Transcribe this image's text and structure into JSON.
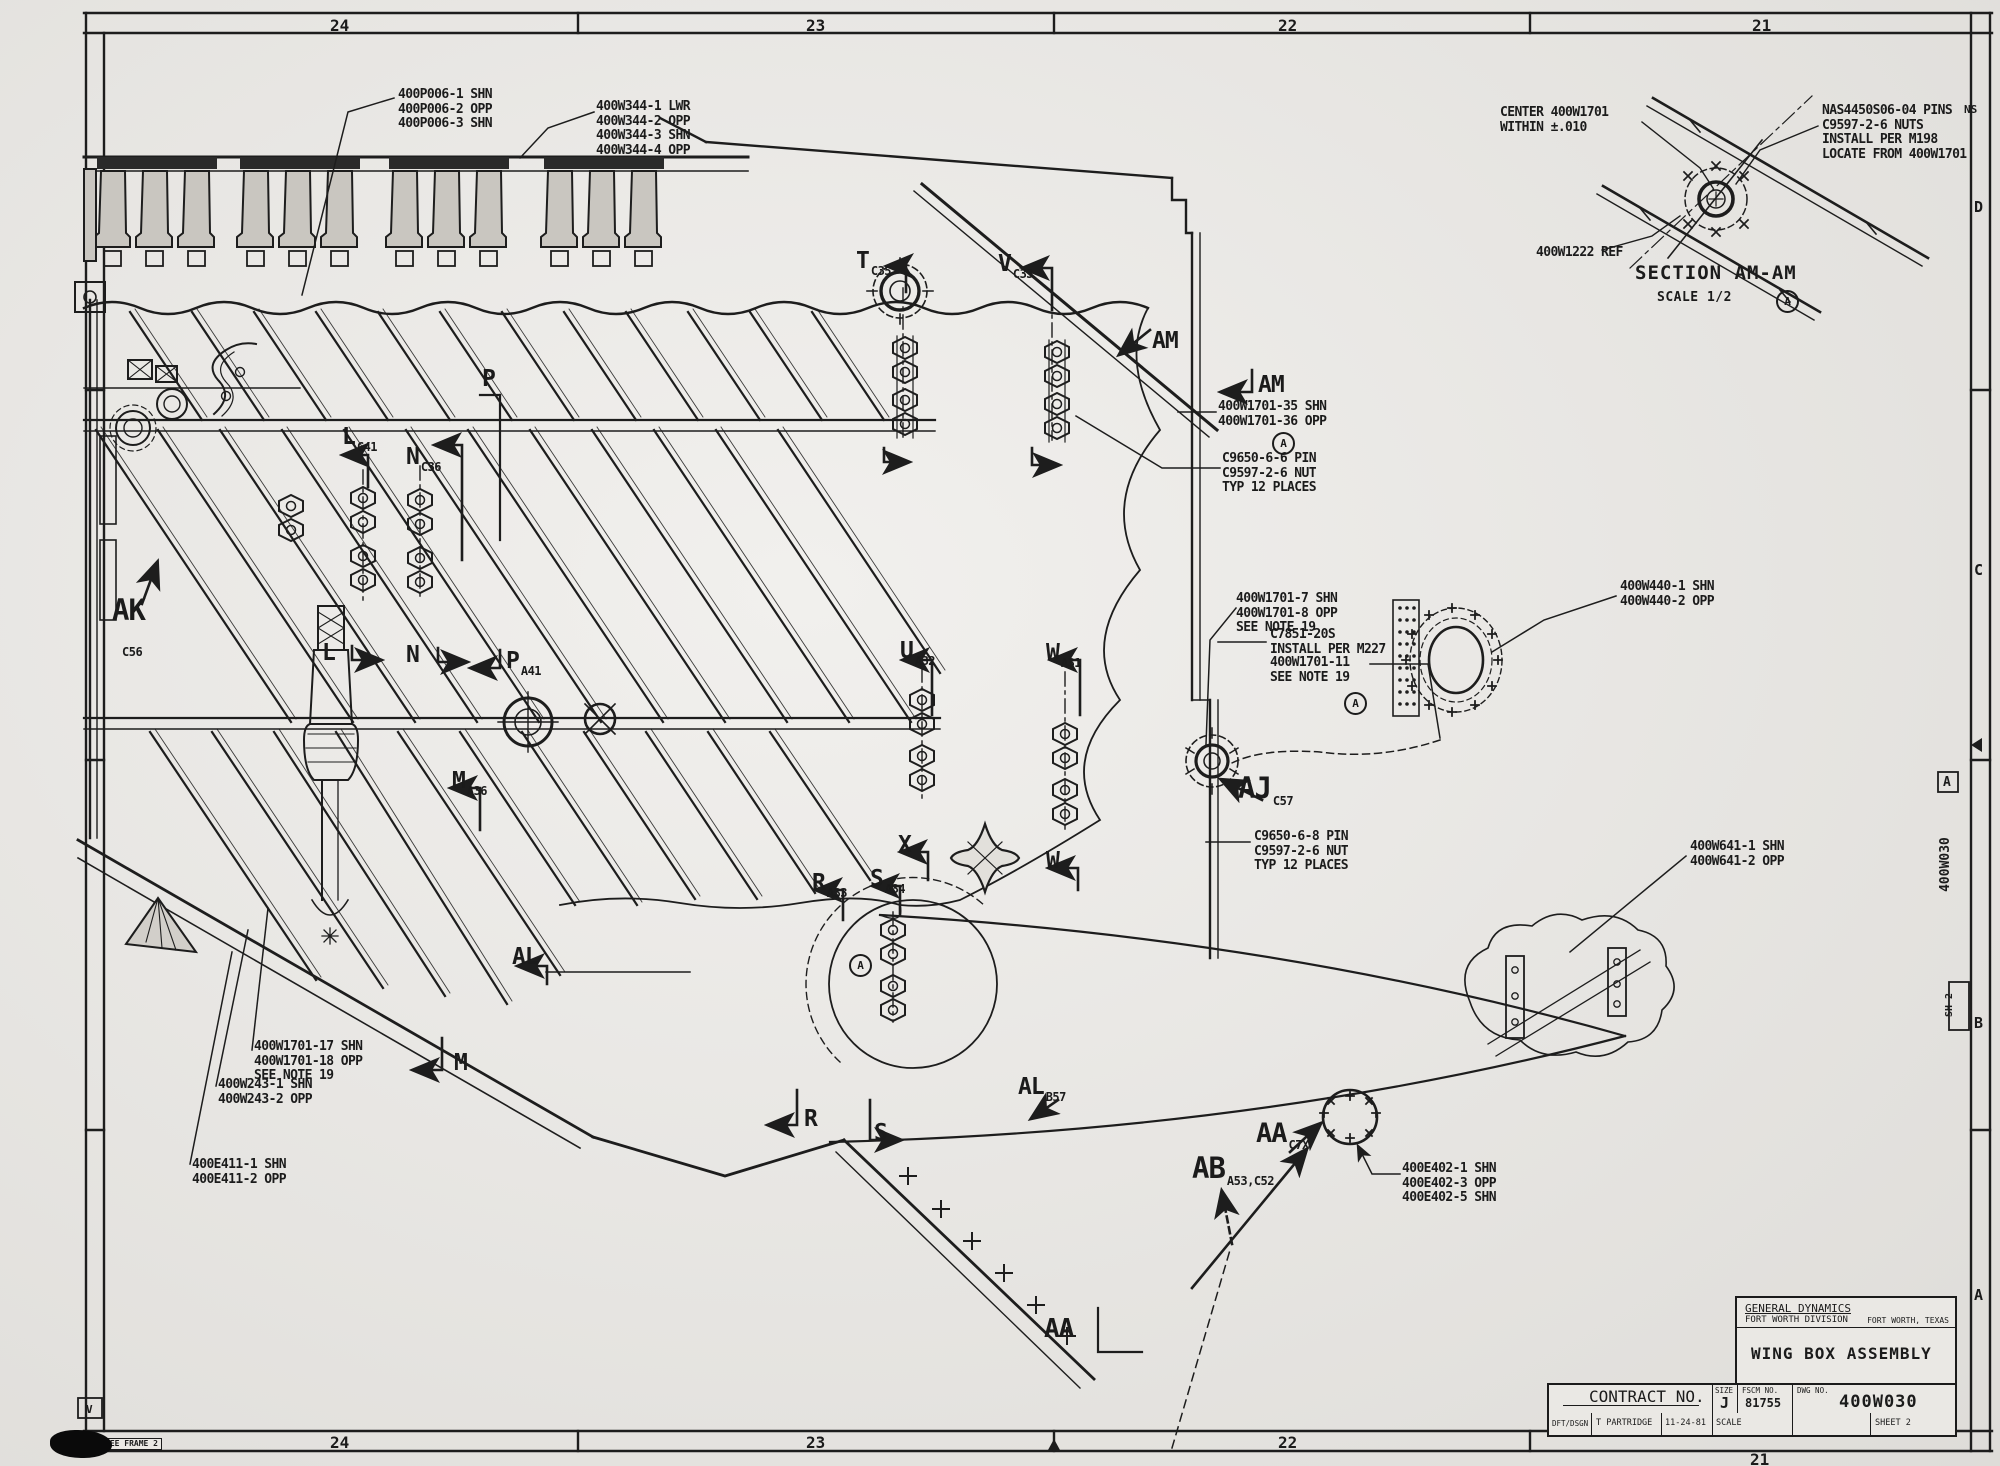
{
  "drawing": {
    "company": "GENERAL DYNAMICS",
    "division": "FORT WORTH DIVISION",
    "location": "FORT WORTH, TEXAS",
    "title": "WING BOX ASSEMBLY",
    "contract_label": "CONTRACT NO.",
    "size_label": "SIZE",
    "size": "J",
    "fscm_label": "FSCM NO.",
    "fscm": "81755",
    "dwg_label": "DWG NO.",
    "dwg_no": "400W030",
    "dft_label": "DFT/DSGN",
    "draftsman": "T PARTRIDGE",
    "date": "11-24-81",
    "scale_label": "SCALE",
    "sheet": "SHEET 2"
  },
  "border": {
    "zones_top": [
      "24",
      "23",
      "22",
      "21"
    ],
    "zones_bottom": [
      "24",
      "23",
      "22",
      "21"
    ],
    "zone_letters": [
      "D",
      "C",
      "B",
      "A"
    ],
    "flag_a": "A",
    "corner_fragment": "NS",
    "vertical_dwg": "400W030",
    "vertical_sh": "SH 2",
    "frame_box_left": "AME 1",
    "frame_box_note": "SEE FRAME 2",
    "rev_flag": "V"
  },
  "section_detail": {
    "title": "SECTION AM-AM",
    "scale": "SCALE 1/2",
    "flag": "A"
  },
  "flags": {
    "circled_a": "A"
  },
  "callouts": [
    {
      "id": "400p006",
      "lines": [
        "400P006-1 SHN",
        "400P006-2 OPP",
        "400P006-3 SHN"
      ]
    },
    {
      "id": "400w344",
      "lines": [
        "400W344-1 LWR",
        "400W344-2 OPP",
        "400W344-3 SHN",
        "400W344-4 OPP"
      ]
    },
    {
      "id": "center-400w1701",
      "lines": [
        "CENTER 400W1701",
        "WITHIN ±.010"
      ]
    },
    {
      "id": "nas-pins",
      "lines": [
        "NAS4450S06-04 PINS",
        "C9597-2-6 NUTS",
        "INSTALL PER M198",
        "LOCATE FROM 400W1701"
      ]
    },
    {
      "id": "400w1222",
      "lines": [
        "400W1222 REF"
      ]
    },
    {
      "id": "400w1701-35",
      "lines": [
        "400W1701-35 SHN",
        "400W1701-36 OPP"
      ]
    },
    {
      "id": "pin-c9650-6-6",
      "lines": [
        "C9650-6-6 PIN",
        "C9597-2-6 NUT",
        "TYP 12 PLACES"
      ]
    },
    {
      "id": "400w1701-7",
      "lines": [
        "400W1701-7 SHN",
        "400W1701-8 OPP",
        "SEE NOTE 19"
      ]
    },
    {
      "id": "c7851",
      "lines": [
        "C7851-20S",
        "INSTALL PER M227"
      ]
    },
    {
      "id": "400w1701-11",
      "lines": [
        "400W1701-11",
        "SEE NOTE 19"
      ]
    },
    {
      "id": "400w440",
      "lines": [
        "400W440-1 SHN",
        "400W440-2 OPP"
      ]
    },
    {
      "id": "400w641",
      "lines": [
        "400W641-1 SHN",
        "400W641-2 OPP"
      ]
    },
    {
      "id": "pin-c9650-6-8",
      "lines": [
        "C9650-6-8 PIN",
        "C9597-2-6 NUT",
        "TYP 12 PLACES"
      ]
    },
    {
      "id": "400w1701-17",
      "lines": [
        "400W1701-17 SHN",
        "400W1701-18 OPP",
        "SEE NOTE 19"
      ]
    },
    {
      "id": "400w243",
      "lines": [
        "400W243-1 SHN",
        "400W243-2 OPP"
      ]
    },
    {
      "id": "400e411",
      "lines": [
        "400E411-1 SHN",
        "400E411-2 OPP"
      ]
    },
    {
      "id": "400e402",
      "lines": [
        "400E402-1 SHN",
        "400E402-3 OPP",
        "400E402-5 SHN"
      ]
    }
  ],
  "labels": [
    {
      "letter": "T",
      "sub": "C35"
    },
    {
      "letter": "V",
      "sub": "C33"
    },
    {
      "letter": "AM",
      "sub": ""
    },
    {
      "letter": "AM",
      "sub": ""
    },
    {
      "letter": "P",
      "sub": ""
    },
    {
      "letter": "L",
      "sub": "C41"
    },
    {
      "letter": "N",
      "sub": "C36"
    },
    {
      "letter": "AK",
      "sub": "C56"
    },
    {
      "letter": "L",
      "sub": ""
    },
    {
      "letter": "N",
      "sub": ""
    },
    {
      "letter": "P",
      "sub": "A41"
    },
    {
      "letter": "U",
      "sub": "A32"
    },
    {
      "letter": "W",
      "sub": "A31"
    },
    {
      "letter": "M",
      "sub": "A36"
    },
    {
      "letter": "AJ",
      "sub": "C57"
    },
    {
      "letter": "X",
      "sub": ""
    },
    {
      "letter": "W",
      "sub": ""
    },
    {
      "letter": "R",
      "sub": "A33"
    },
    {
      "letter": "S",
      "sub": "A34"
    },
    {
      "letter": "AL",
      "sub": ""
    },
    {
      "letter": "M",
      "sub": ""
    },
    {
      "letter": "R",
      "sub": ""
    },
    {
      "letter": "S",
      "sub": ""
    },
    {
      "letter": "AL",
      "sub": "B57"
    },
    {
      "letter": "AB",
      "sub": "A53,C52"
    },
    {
      "letter": "AA",
      "sub": "C7X"
    },
    {
      "letter": "AA",
      "sub": ""
    }
  ]
}
